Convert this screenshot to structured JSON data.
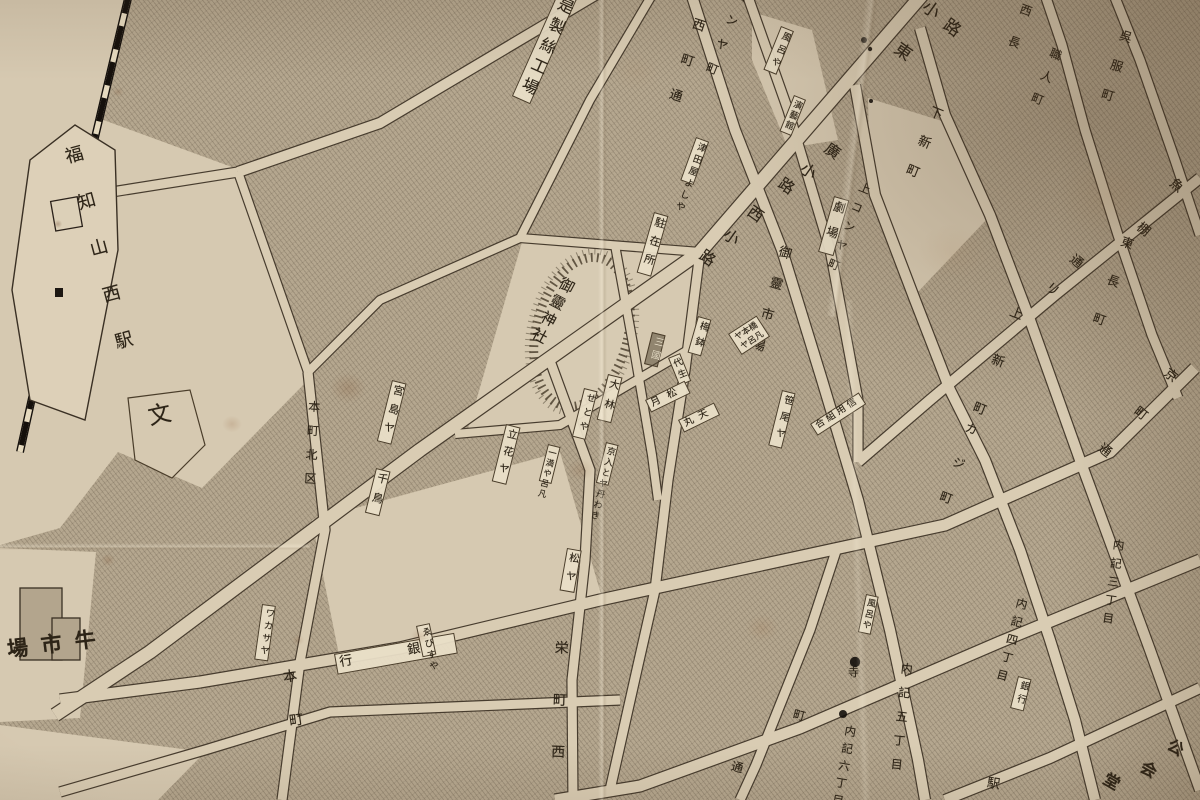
{
  "colors": {
    "paper": "#ddd0b8",
    "block_hatch": "#b5a78f",
    "street_fill": "#d9ccb3",
    "line_ink": "#473c2e",
    "text_ink": "#2d2417",
    "label_box": "#e9deC7",
    "railway_black": "#15100c"
  },
  "labels": {
    "station": "福知山西駅",
    "factory": "郡是製絲工場",
    "shrine": "御靈神社",
    "school": "文",
    "market": "場市牛",
    "police": "駐在所",
    "theater": "劇場",
    "hall": "演藝館",
    "bank_west": "行銀",
    "bank_east": "銀行",
    "credit_union": "合組用信",
    "station_partial": "駅",
    "tera": "寺"
  },
  "streets": {
    "nishimachi_dori": "西町通",
    "konya_machi": "コンヤ町",
    "kami_konya_machi": "上コンヤ町",
    "honmachi_kitaku": "本町北区",
    "honmachi": "本町",
    "sakae_machi_nishi": "栄町西",
    "goryo_ichiba": "御靈市場",
    "shimo_shinmachi": "下新町",
    "kami_shinmachi": "上新町",
    "kaji_machi": "カジ町",
    "naiki_3": "内記三丁目",
    "naiki_4": "内記四丁目",
    "naiki_5": "内記五丁目",
    "naiki_6": "内記六丁目",
    "nishinaga": "西長",
    "shokunin_machi": "職人町",
    "gofuku_machi": "呉服町",
    "higashinaga_machi": "東長町"
  },
  "street_chars": {
    "higashi_koji": [
      "東",
      "小",
      "路"
    ],
    "hiro_koji": [
      "廣",
      "小",
      "路"
    ],
    "nishi_koji": [
      "西",
      "小",
      "路"
    ],
    "uotana_dori": [
      "魚",
      "棚",
      "通",
      "リ"
    ],
    "kyomachi_dori": [
      "京",
      "町",
      "通"
    ],
    "kokaido": [
      "公",
      "会",
      "堂"
    ],
    "machi_dori": [
      "町",
      "通"
    ]
  },
  "shops": {
    "furoya_top": "風呂や",
    "tsutaya_yoshiya": "津田屋よしや",
    "umebachi": "梅鉢",
    "mikuni": "三國",
    "yayoi": "代生",
    "hashimotoya": "ヤ本橋",
    "furoya_mid": "ヤ呂凡",
    "obayashi": "大林",
    "setoya": "せとや",
    "tsukimatsu": "月松",
    "tenmaru": "丸天",
    "kyoiri": "京入とヤ丹わき",
    "manya": "一満や呂凡",
    "miyajimaya": "宮島ヤ",
    "chidori": "千鳥",
    "tachibanaya": "立花ヤ",
    "sasaoya": "笹尾ヤ",
    "wakasaya": "ワカサヤ",
    "ebisuya": "ゑびすや",
    "matsuya": "松ヤ",
    "furoya_east": "風呂や"
  }
}
